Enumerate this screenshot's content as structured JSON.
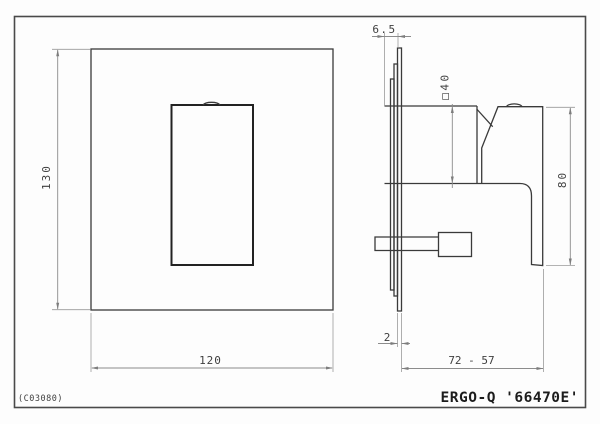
{
  "drawing": {
    "code": "(C03080)",
    "title": "ERGO-Q '66470E'",
    "views": {
      "front": {
        "height_label": "130",
        "width_label": "120"
      },
      "side": {
        "protrusion_label": "6.5",
        "body_square_label": "□40",
        "handle_height_label": "80",
        "plate_thickness_label": "2",
        "depth_range_label": "72 - 57"
      }
    },
    "colors": {
      "background": "#fdfdfd",
      "main_line": "#3a3a3a",
      "dimension_line": "#8c8c8c",
      "text": "#3f3f3f",
      "border": "#4a4a4a"
    }
  }
}
